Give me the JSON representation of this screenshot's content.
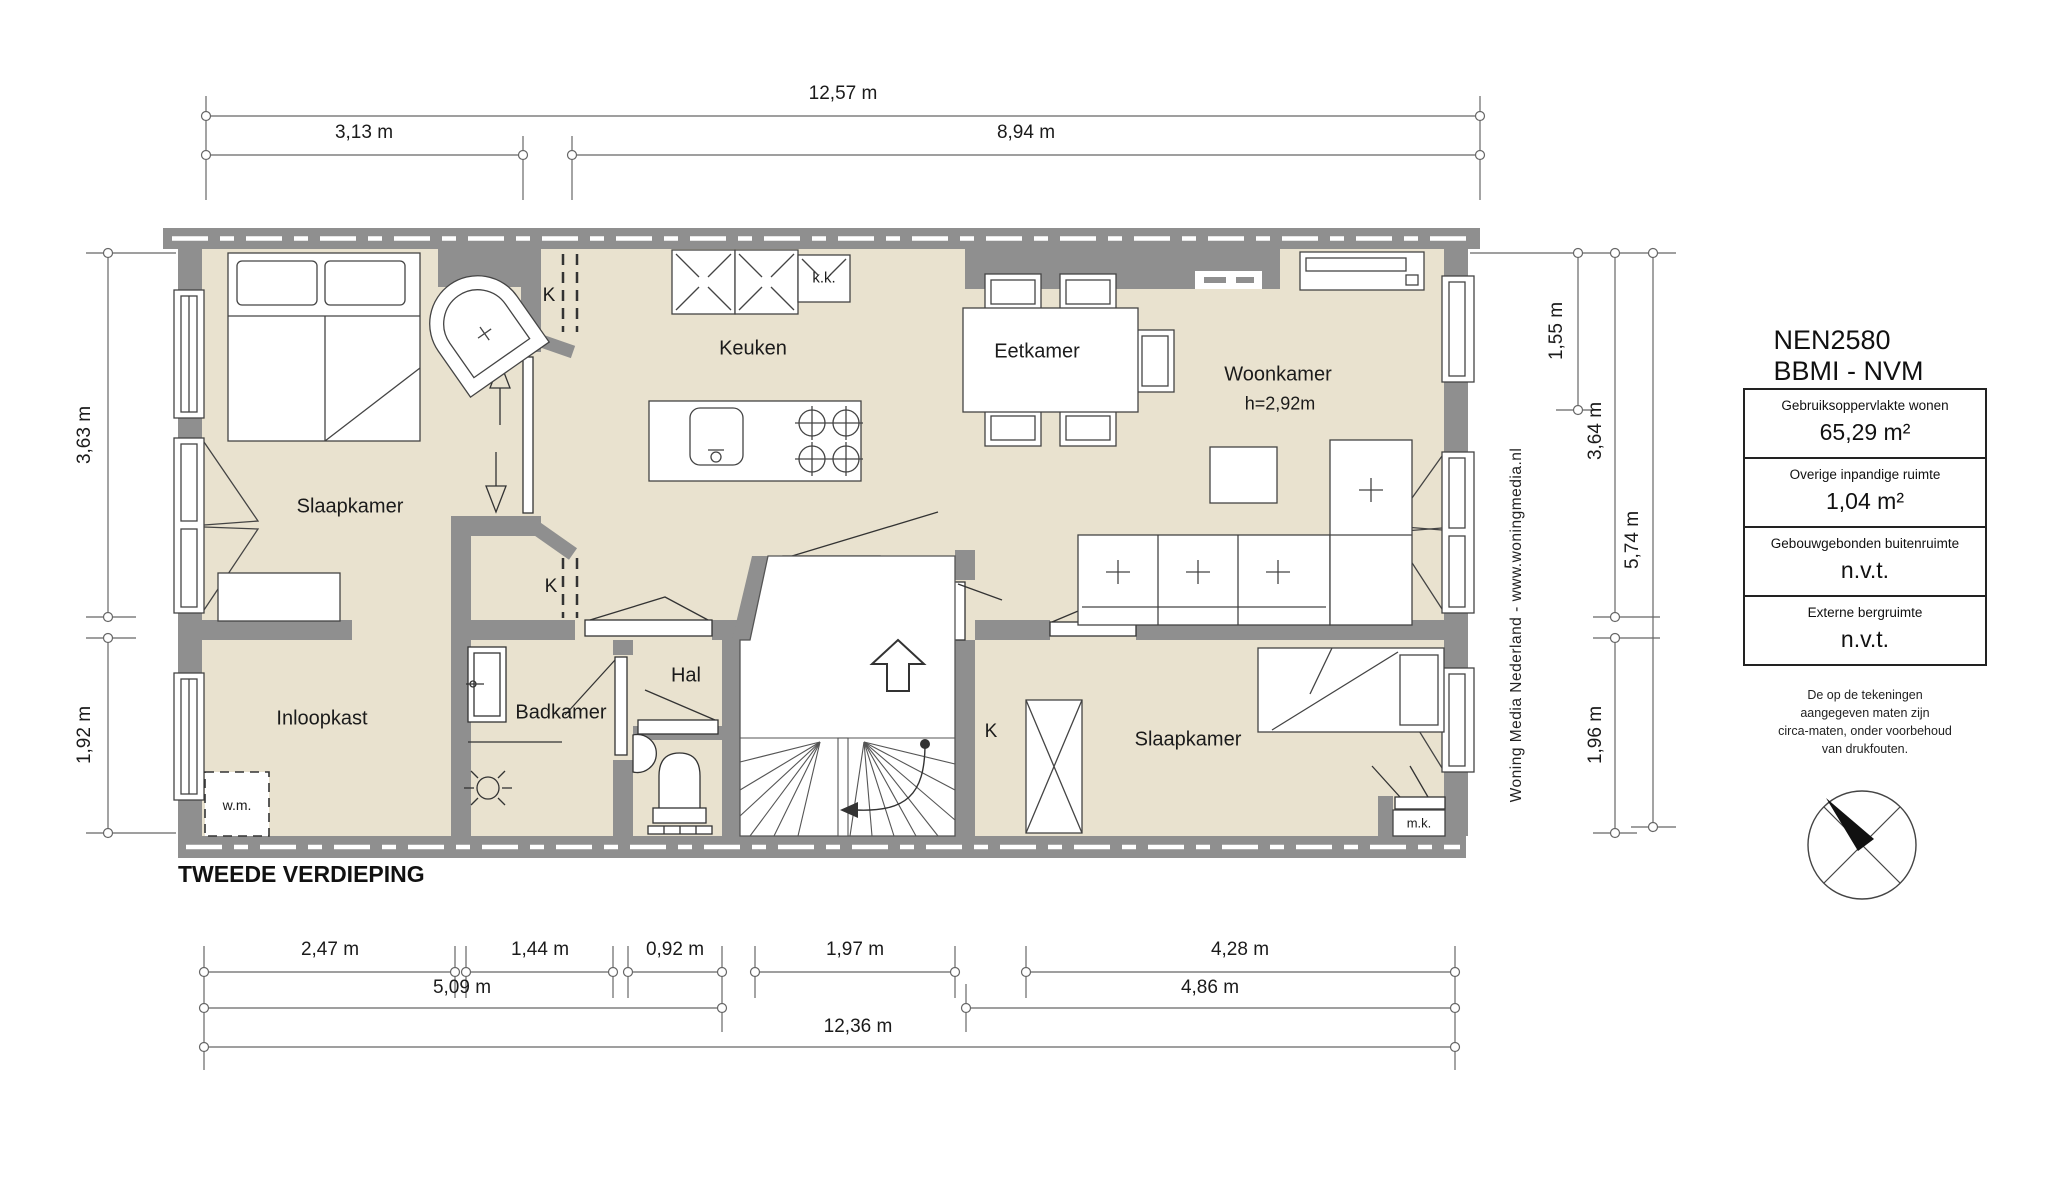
{
  "plan_title": "TWEEDE VERDIEPING",
  "rooms": {
    "slaapkamer_left": "Slaapkamer",
    "keuken": "Keuken",
    "eetkamer": "Eetkamer",
    "woonkamer": "Woonkamer",
    "woonkamer_height": "h=2,92m",
    "inloopkast": "Inloopkast",
    "badkamer": "Badkamer",
    "hal": "Hal",
    "slaapkamer_right": "Slaapkamer"
  },
  "labels": {
    "k_top": "K",
    "k_mid": "K",
    "k_right": "K",
    "kk": "k.k.",
    "wm": "w.m.",
    "mk": "m.k."
  },
  "dimensions": {
    "top_total": "12,57 m",
    "top_left": "3,13 m",
    "top_right": "8,94 m",
    "left_upper": "3,63 m",
    "left_lower": "1,92 m",
    "right_1": "1,55 m",
    "right_2": "3,64 m",
    "right_3": "5,74 m",
    "right_4": "1,96 m",
    "bottom_r1": [
      "2,47 m",
      "1,44 m",
      "0,92 m",
      "1,97 m",
      "4,28 m"
    ],
    "bottom_r2_left": "5,09 m",
    "bottom_r2_right": "4,86 m",
    "bottom_total": "12,36 m"
  },
  "info_panel": {
    "title": "NEN2580 BBMI - NVM",
    "rows": [
      {
        "label": "Gebruiksoppervlakte wonen",
        "value": "65,29 m²"
      },
      {
        "label": "Overige inpandige ruimte",
        "value": "1,04 m²"
      },
      {
        "label": "Gebouwgebonden buitenruimte",
        "value": "n.v.t."
      },
      {
        "label": "Externe bergruimte",
        "value": "n.v.t."
      }
    ],
    "disclaimer_line1": "De op de tekeningen aangegeven maten zijn",
    "disclaimer_line2": "circa-maten, onder voorbehoud van drukfouten."
  },
  "watermark": "Woning Media Nederland - www.woningmedia.nl",
  "colors": {
    "wall": "#8f8f8f",
    "floor": "#e9e2cf",
    "line": "#444444"
  }
}
